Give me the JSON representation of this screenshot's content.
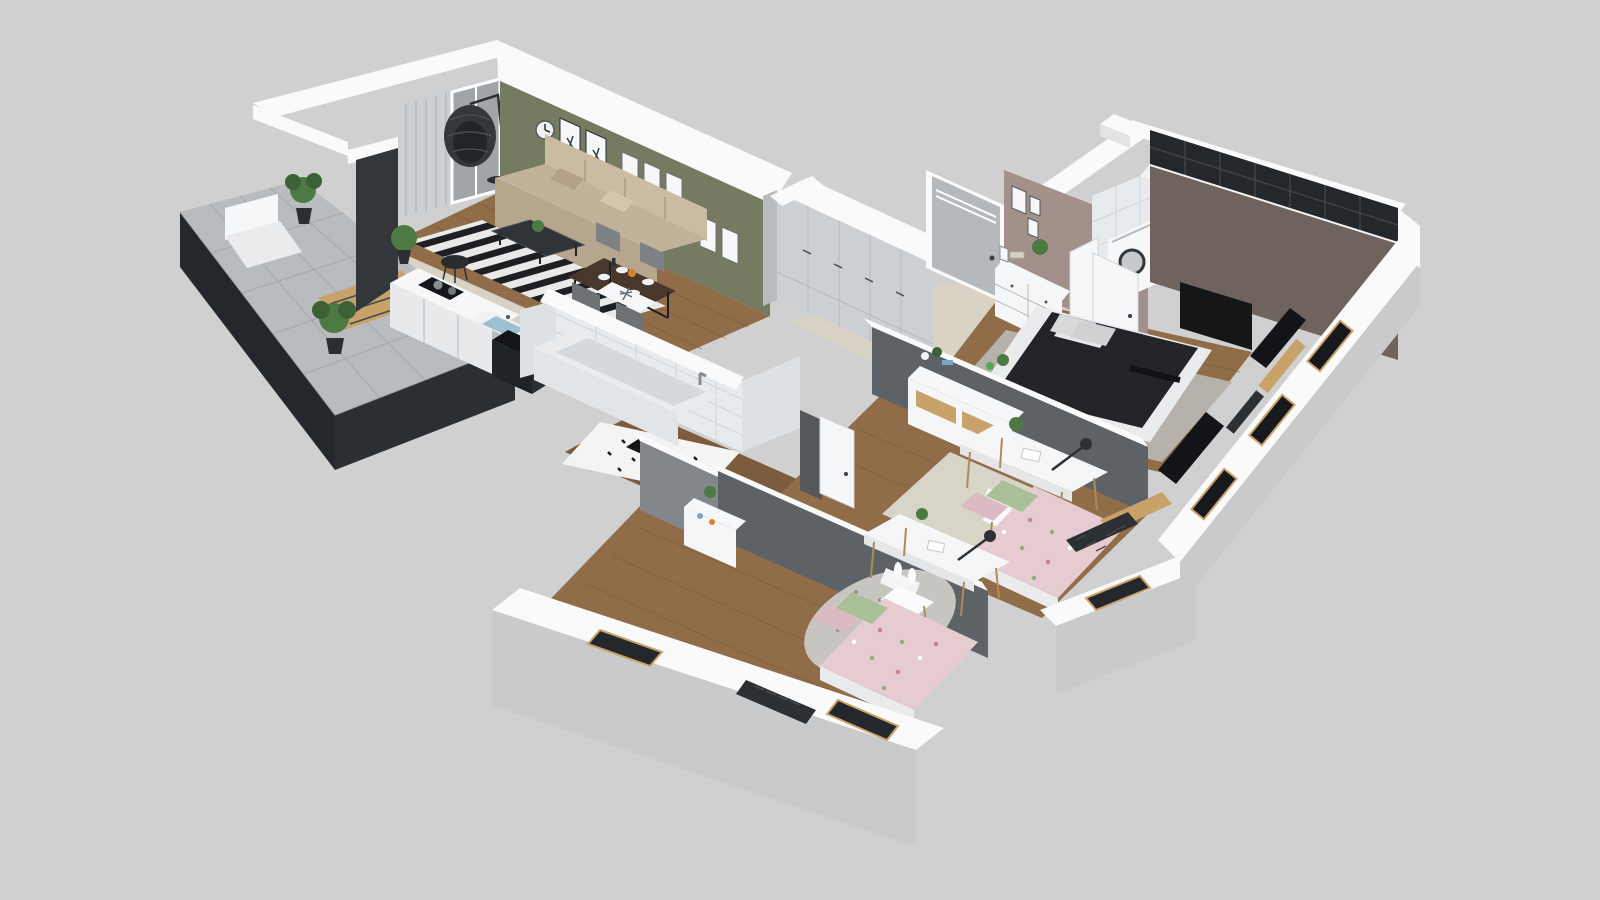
{
  "image_type": "3d-floor-plan-render",
  "view": "axonometric-cutaway",
  "background": "#d0d0d0",
  "palette": {
    "background": "#d0d0d0",
    "band_white": "#fafafa",
    "exterior_gray": "#c8cacc",
    "wall_green": "#747b60",
    "wall_mauve": "#a3908a",
    "wall_taupe": "#6f645d",
    "wall_slate": "#5d6267",
    "tile_white": "#e8ebed",
    "floor_wood": "#916c48",
    "floor_wood_dark": "#7d5c3d",
    "floor_beige": "#d9d3c5",
    "balcony_tile": "#b9bcbf",
    "glass_dark": "#24282c",
    "sofa_beige": "#c1b29a",
    "rug_black": "#1d1f22",
    "rug_white": "#e9e9e7",
    "table_wood": "#48372a",
    "chair_gray": "#7e8285",
    "duvet_black": "#222428",
    "bed_pink": "#e6cbd1",
    "pillow_green": "#a9c098",
    "pillow_pink": "#dcbac4",
    "desk_white": "#f5f6f7",
    "wood_tan": "#c9a269",
    "plant_green": "#4d7a42",
    "radiator_dark": "#2c3033",
    "niche_black": "#141618"
  },
  "scene": {
    "rooms": [
      {
        "name": "balcony",
        "items": [
          "glass-railing",
          "tile-floor",
          "armchair",
          "wood-bench",
          "potted-plant",
          "potted-plant"
        ]
      },
      {
        "name": "living-room",
        "items": [
          "olive-feature-wall",
          "wall-clock",
          "picture-frames",
          "corner-sofa",
          "striped-rug",
          "coffee-table",
          "side-table",
          "dining-table",
          "dining-chairs",
          "curtains",
          "balcony-door",
          "hanging-egg-chair",
          "kitchen-counter",
          "cooktop",
          "sink",
          "duct-shaft",
          "potted-plant"
        ]
      },
      {
        "name": "bathroom",
        "items": [
          "bathtub",
          "tiled-walls",
          "checkerboard-floor",
          "vent-badge"
        ]
      },
      {
        "name": "hallway",
        "items": [
          "wardrobe",
          "entrance-door",
          "dresser",
          "picture-frames",
          "beige-floor"
        ]
      },
      {
        "name": "wc-laundry",
        "items": [
          "washing-machine",
          "tiled-walls",
          "door"
        ]
      },
      {
        "name": "master-bedroom",
        "items": [
          "window-band",
          "tv-niche",
          "double-bed",
          "pillows",
          "area-rug",
          "door",
          "radiator-window"
        ]
      },
      {
        "name": "kids-bedroom-1",
        "items": [
          "bed",
          "desk",
          "desk-chair",
          "desk-lamp",
          "round-rug",
          "shelf",
          "door",
          "radiator-window"
        ]
      },
      {
        "name": "kids-bedroom-2",
        "items": [
          "bed",
          "desk",
          "desk-chair",
          "desk-lamp",
          "rug",
          "sideboard",
          "radiator-window"
        ]
      }
    ]
  }
}
